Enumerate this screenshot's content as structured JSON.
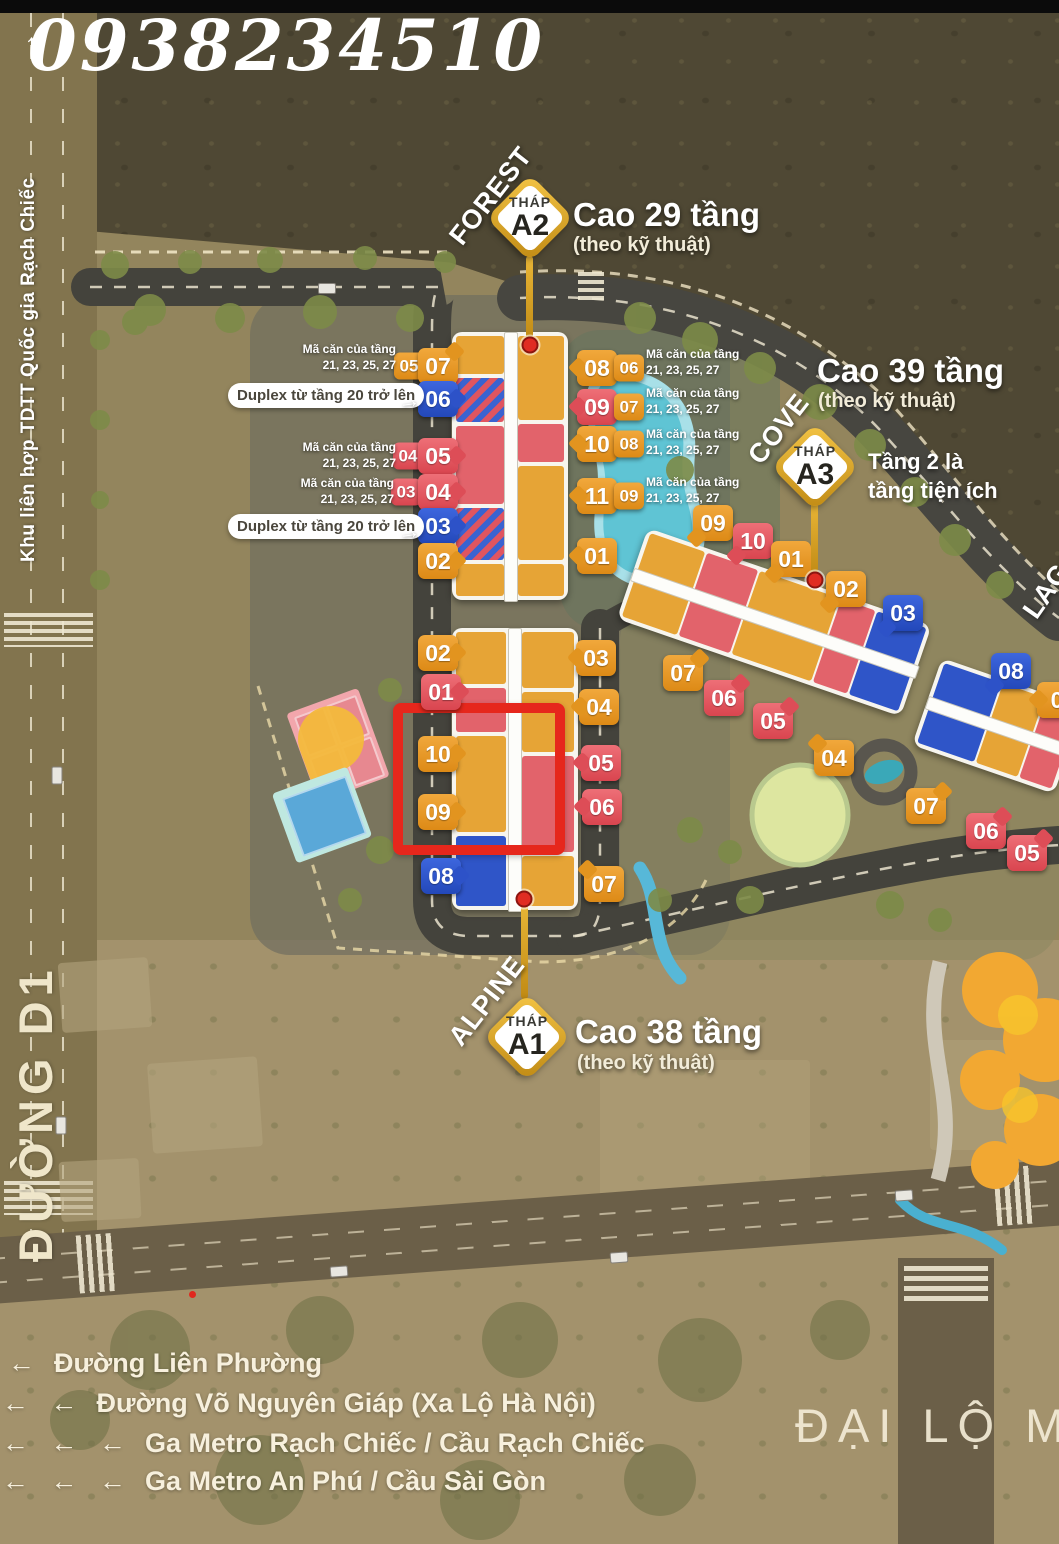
{
  "watermark": {
    "phone": "0938234510"
  },
  "side_labels": {
    "left_top_vertical": "Khu liên hợp TDTT Quốc gia Rạch Chiếc",
    "left_road_vertical": "ĐƯỜNG D1",
    "bottom_right_avenue": "ĐẠI LỘ MA",
    "lagoon": "LAGO"
  },
  "towers": [
    {
      "id": "A2",
      "area": "FOREST",
      "thap": "THÁP",
      "code": "A2",
      "height": "Cao 29 tầng",
      "height_note": "(theo kỹ thuật)"
    },
    {
      "id": "A3",
      "area": "COVE",
      "thap": "THÁP",
      "code": "A3",
      "height": "Cao 39 tầng",
      "height_note": "(theo kỹ thuật)",
      "amenity_line1": "Tầng 2 là",
      "amenity_line2": "tầng tiện ích"
    },
    {
      "id": "A1",
      "area": "ALPINE",
      "thap": "THÁP",
      "code": "A1",
      "height": "Cao 38 tầng",
      "height_note": "(theo kỹ thuật)"
    }
  ],
  "annotations": {
    "duplex_note": "Duplex từ tầng 20 trở lên",
    "duplex_arrow": "→",
    "ma_can_line1": "Mã căn của tầng",
    "ma_can_line2": "21, 23, 25, 27",
    "up_arrow": "↑",
    "legend_arrow": "←"
  },
  "duplex_pills": [
    {
      "x": 228,
      "y": 383,
      "arrow_x": 398,
      "arrow_y": 388
    },
    {
      "x": 228,
      "y": 514,
      "arrow_x": 398,
      "arrow_y": 519
    }
  ],
  "ma_can_notes": [
    {
      "x": 396,
      "y": 357,
      "align": "right"
    },
    {
      "x": 396,
      "y": 455,
      "align": "right"
    },
    {
      "x": 394,
      "y": 491,
      "align": "right"
    },
    {
      "x": 646,
      "y": 362,
      "align": "left"
    },
    {
      "x": 646,
      "y": 401,
      "align": "left"
    },
    {
      "x": 646,
      "y": 442,
      "align": "left"
    },
    {
      "x": 646,
      "y": 490,
      "align": "left"
    }
  ],
  "unit_badges": [
    {
      "label": "05",
      "color": "orange",
      "size": "s",
      "x": 409,
      "y": 366
    },
    {
      "label": "07",
      "color": "orange",
      "size": "l",
      "x": 438,
      "y": 366,
      "tail": "tr"
    },
    {
      "label": "06",
      "color": "blue",
      "size": "l",
      "x": 438,
      "y": 399,
      "tail": "r"
    },
    {
      "label": "04",
      "color": "red",
      "size": "s",
      "x": 408,
      "y": 456
    },
    {
      "label": "05",
      "color": "red",
      "size": "l",
      "x": 438,
      "y": 456,
      "tail": "r"
    },
    {
      "label": "03",
      "color": "red",
      "size": "s",
      "x": 406,
      "y": 492
    },
    {
      "label": "04",
      "color": "red",
      "size": "l",
      "x": 438,
      "y": 492,
      "tail": "r"
    },
    {
      "label": "03",
      "color": "blue",
      "size": "l",
      "x": 438,
      "y": 526,
      "tail": "r"
    },
    {
      "label": "02",
      "color": "orange",
      "size": "l",
      "x": 438,
      "y": 561,
      "tail": "r"
    },
    {
      "label": "08",
      "color": "orange",
      "size": "l",
      "x": 597,
      "y": 368,
      "tail": "l"
    },
    {
      "label": "06",
      "color": "orange",
      "size": "s",
      "x": 629,
      "y": 368
    },
    {
      "label": "09",
      "color": "red",
      "size": "l",
      "x": 597,
      "y": 407,
      "tail": "l"
    },
    {
      "label": "07",
      "color": "orange",
      "size": "s",
      "x": 629,
      "y": 407
    },
    {
      "label": "10",
      "color": "orange",
      "size": "l",
      "x": 597,
      "y": 444,
      "tail": "l"
    },
    {
      "label": "08",
      "color": "orange",
      "size": "s",
      "x": 629,
      "y": 444
    },
    {
      "label": "11",
      "color": "orange",
      "size": "l",
      "x": 597,
      "y": 496,
      "tail": "l"
    },
    {
      "label": "09",
      "color": "orange",
      "size": "s",
      "x": 629,
      "y": 496
    },
    {
      "label": "01",
      "color": "orange",
      "size": "l",
      "x": 597,
      "y": 556,
      "tail": "l"
    },
    {
      "label": "02",
      "color": "orange",
      "size": "l",
      "x": 438,
      "y": 653,
      "tail": "r"
    },
    {
      "label": "01",
      "color": "red",
      "size": "l",
      "x": 441,
      "y": 692,
      "tail": "r"
    },
    {
      "label": "10",
      "color": "orange",
      "size": "l",
      "x": 438,
      "y": 754,
      "tail": "r"
    },
    {
      "label": "09",
      "color": "orange",
      "size": "l",
      "x": 438,
      "y": 812,
      "tail": "r"
    },
    {
      "label": "08",
      "color": "blue",
      "size": "l",
      "x": 441,
      "y": 876,
      "tail": "r"
    },
    {
      "label": "03",
      "color": "orange",
      "size": "l",
      "x": 596,
      "y": 658,
      "tail": "l"
    },
    {
      "label": "04",
      "color": "orange",
      "size": "l",
      "x": 599,
      "y": 707,
      "tail": "l"
    },
    {
      "label": "05",
      "color": "red",
      "size": "l",
      "x": 601,
      "y": 763,
      "tail": "l"
    },
    {
      "label": "06",
      "color": "red",
      "size": "l",
      "x": 602,
      "y": 807,
      "tail": "l"
    },
    {
      "label": "07",
      "color": "orange",
      "size": "l",
      "x": 604,
      "y": 884,
      "tail": "tl"
    },
    {
      "label": "09",
      "color": "orange",
      "size": "l",
      "x": 713,
      "y": 523,
      "tail": "bl"
    },
    {
      "label": "10",
      "color": "red",
      "size": "l",
      "x": 753,
      "y": 541,
      "tail": "bl"
    },
    {
      "label": "01",
      "color": "orange",
      "size": "l",
      "x": 791,
      "y": 559,
      "tail": "bl"
    },
    {
      "label": "02",
      "color": "orange",
      "size": "l",
      "x": 846,
      "y": 589,
      "tail": "bl"
    },
    {
      "label": "03",
      "color": "blue",
      "size": "l",
      "x": 903,
      "y": 613,
      "tail": "bl"
    },
    {
      "label": "07",
      "color": "orange",
      "size": "l",
      "x": 683,
      "y": 673,
      "tail": "tr"
    },
    {
      "label": "06",
      "color": "red",
      "size": "l",
      "x": 724,
      "y": 698,
      "tail": "tr"
    },
    {
      "label": "05",
      "color": "red",
      "size": "l",
      "x": 773,
      "y": 721,
      "tail": "tr"
    },
    {
      "label": "04",
      "color": "orange",
      "size": "l",
      "x": 834,
      "y": 758,
      "tail": "tl"
    },
    {
      "label": "08",
      "color": "blue",
      "size": "l",
      "x": 1011,
      "y": 671,
      "tail": "bl"
    },
    {
      "label": "0",
      "color": "orange",
      "size": "l",
      "x": 1057,
      "y": 700,
      "tail": "l"
    },
    {
      "label": "07",
      "color": "orange",
      "size": "l",
      "x": 926,
      "y": 806,
      "tail": "tr"
    },
    {
      "label": "06",
      "color": "red",
      "size": "l",
      "x": 986,
      "y": 831,
      "tail": "tr"
    },
    {
      "label": "05",
      "color": "red",
      "size": "l",
      "x": 1027,
      "y": 853,
      "tail": "tr"
    }
  ],
  "legend": {
    "rows": [
      {
        "arrows": 1,
        "text": "Đường Liên Phường",
        "x": 8,
        "y": 1348
      },
      {
        "arrows": 2,
        "text": "Đường Võ Nguyên Giáp (Xa Lộ Hà Nội)",
        "x": 2,
        "y": 1388
      },
      {
        "arrows": 3,
        "text": "Ga Metro Rạch Chiếc / Cầu Rạch Chiếc",
        "x": 2,
        "y": 1428
      },
      {
        "arrows": 3,
        "text": "Ga Metro An Phú / Cầu Sài Gòn",
        "x": 2,
        "y": 1466
      }
    ]
  },
  "colors": {
    "badge_orange": "#e6a436",
    "badge_red": "#e2636b",
    "badge_blue": "#2f55c8",
    "pin_gold": "#d9a21b",
    "highlight_red": "#e6271c"
  }
}
